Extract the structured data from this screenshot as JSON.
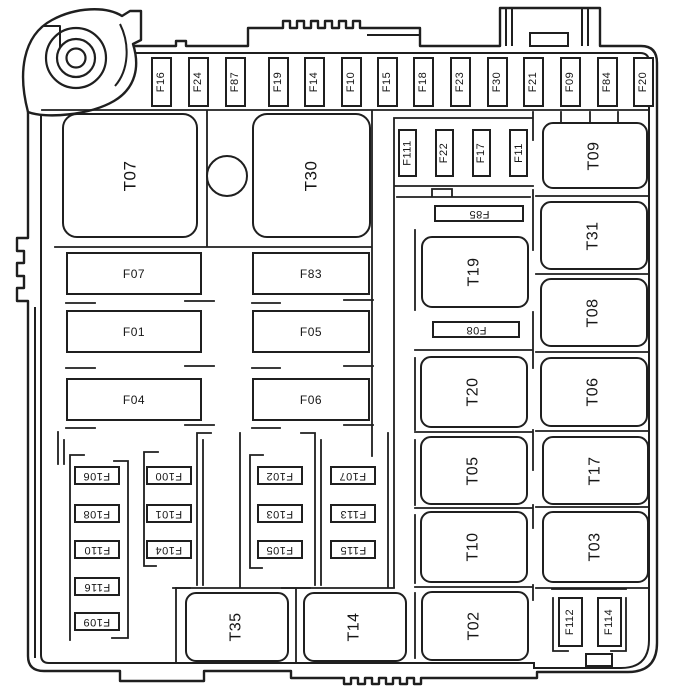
{
  "diagram": {
    "title": "Engine compartment fuse box layout",
    "type": "fuse-relay-box",
    "background_color": "#ffffff",
    "line_color": "#1f1f1f"
  },
  "top_fuse_row": {
    "y": 57,
    "w": 21,
    "h": 50,
    "rotation": "bottom-to-top",
    "items": [
      {
        "label": "F16",
        "x": 151
      },
      {
        "label": "F24",
        "x": 188
      },
      {
        "label": "F87",
        "x": 225
      },
      {
        "label": "F19",
        "x": 268
      },
      {
        "label": "F14",
        "x": 304
      },
      {
        "label": "F10",
        "x": 341
      },
      {
        "label": "F15",
        "x": 377
      },
      {
        "label": "F18",
        "x": 413
      },
      {
        "label": "F23",
        "x": 450
      },
      {
        "label": "F30",
        "x": 487
      },
      {
        "label": "F21",
        "x": 523
      },
      {
        "label": "F09",
        "x": 560
      },
      {
        "label": "F84",
        "x": 597
      },
      {
        "label": "F20",
        "x": 633
      }
    ]
  },
  "mid_fuse_row": {
    "y": 129,
    "w": 19,
    "h": 48,
    "rotation": "bottom-to-top",
    "items": [
      {
        "label": "F111",
        "x": 398
      },
      {
        "label": "F22",
        "x": 435
      },
      {
        "label": "F17",
        "x": 472
      },
      {
        "label": "F11",
        "x": 509
      }
    ]
  },
  "bottom_right_fuses": {
    "rotation": "bottom-to-top",
    "items": [
      {
        "label": "F112",
        "x": 558,
        "y": 597,
        "w": 25,
        "h": 50
      },
      {
        "label": "F114",
        "x": 597,
        "y": 597,
        "w": 25,
        "h": 50
      }
    ]
  },
  "relays": {
    "rotation": "bottom-to-top",
    "items": [
      {
        "label": "T07",
        "x": 62,
        "y": 113,
        "w": 136,
        "h": 125,
        "big": true
      },
      {
        "label": "T30",
        "x": 252,
        "y": 113,
        "w": 119,
        "h": 125,
        "big": true
      },
      {
        "label": "T09",
        "x": 542,
        "y": 122,
        "w": 106,
        "h": 67
      },
      {
        "label": "T31",
        "x": 540,
        "y": 201,
        "w": 108,
        "h": 69
      },
      {
        "label": "T08",
        "x": 540,
        "y": 278,
        "w": 108,
        "h": 69
      },
      {
        "label": "T06",
        "x": 540,
        "y": 357,
        "w": 108,
        "h": 70
      },
      {
        "label": "T17",
        "x": 542,
        "y": 436,
        "w": 107,
        "h": 69
      },
      {
        "label": "T03",
        "x": 542,
        "y": 511,
        "w": 107,
        "h": 72
      },
      {
        "label": "T19",
        "x": 421,
        "y": 236,
        "w": 108,
        "h": 72
      },
      {
        "label": "T20",
        "x": 420,
        "y": 356,
        "w": 108,
        "h": 72
      },
      {
        "label": "T05",
        "x": 420,
        "y": 436,
        "w": 108,
        "h": 69
      },
      {
        "label": "T10",
        "x": 420,
        "y": 511,
        "w": 108,
        "h": 72
      },
      {
        "label": "T02",
        "x": 421,
        "y": 591,
        "w": 108,
        "h": 70
      },
      {
        "label": "T35",
        "x": 185,
        "y": 592,
        "w": 104,
        "h": 70
      },
      {
        "label": "T14",
        "x": 303,
        "y": 592,
        "w": 104,
        "h": 70
      }
    ]
  },
  "horizontal_fuses": {
    "rotation": "none",
    "items": [
      {
        "label": "F07",
        "x": 66,
        "y": 252,
        "w": 136,
        "h": 43
      },
      {
        "label": "F01",
        "x": 66,
        "y": 310,
        "w": 136,
        "h": 43
      },
      {
        "label": "F04",
        "x": 66,
        "y": 378,
        "w": 136,
        "h": 43
      },
      {
        "label": "F83",
        "x": 252,
        "y": 252,
        "w": 118,
        "h": 43
      },
      {
        "label": "F05",
        "x": 252,
        "y": 310,
        "w": 118,
        "h": 43
      },
      {
        "label": "F06",
        "x": 252,
        "y": 378,
        "w": 118,
        "h": 43
      }
    ]
  },
  "flipped_fuses": {
    "rotation": "upside-down",
    "items": [
      {
        "label": "F85",
        "x": 434,
        "y": 205,
        "w": 90,
        "h": 17
      },
      {
        "label": "F08",
        "x": 432,
        "y": 321,
        "w": 88,
        "h": 17
      },
      {
        "label": "F106",
        "x": 74,
        "y": 466,
        "w": 46,
        "h": 19
      },
      {
        "label": "F108",
        "x": 74,
        "y": 504,
        "w": 46,
        "h": 19
      },
      {
        "label": "F110",
        "x": 74,
        "y": 540,
        "w": 46,
        "h": 19
      },
      {
        "label": "F116",
        "x": 74,
        "y": 577,
        "w": 46,
        "h": 19
      },
      {
        "label": "F109",
        "x": 74,
        "y": 612,
        "w": 46,
        "h": 19
      },
      {
        "label": "F100",
        "x": 146,
        "y": 466,
        "w": 46,
        "h": 19
      },
      {
        "label": "F101",
        "x": 146,
        "y": 504,
        "w": 46,
        "h": 19
      },
      {
        "label": "F104",
        "x": 146,
        "y": 540,
        "w": 46,
        "h": 19
      },
      {
        "label": "F102",
        "x": 257,
        "y": 466,
        "w": 46,
        "h": 19
      },
      {
        "label": "F103",
        "x": 257,
        "y": 504,
        "w": 46,
        "h": 19
      },
      {
        "label": "F105",
        "x": 257,
        "y": 540,
        "w": 46,
        "h": 19
      },
      {
        "label": "F107",
        "x": 330,
        "y": 466,
        "w": 46,
        "h": 19
      },
      {
        "label": "F113",
        "x": 330,
        "y": 504,
        "w": 46,
        "h": 19
      },
      {
        "label": "F115",
        "x": 330,
        "y": 540,
        "w": 46,
        "h": 19
      }
    ]
  },
  "grommet": {
    "cx": 225,
    "cy": 174,
    "r": 19
  }
}
